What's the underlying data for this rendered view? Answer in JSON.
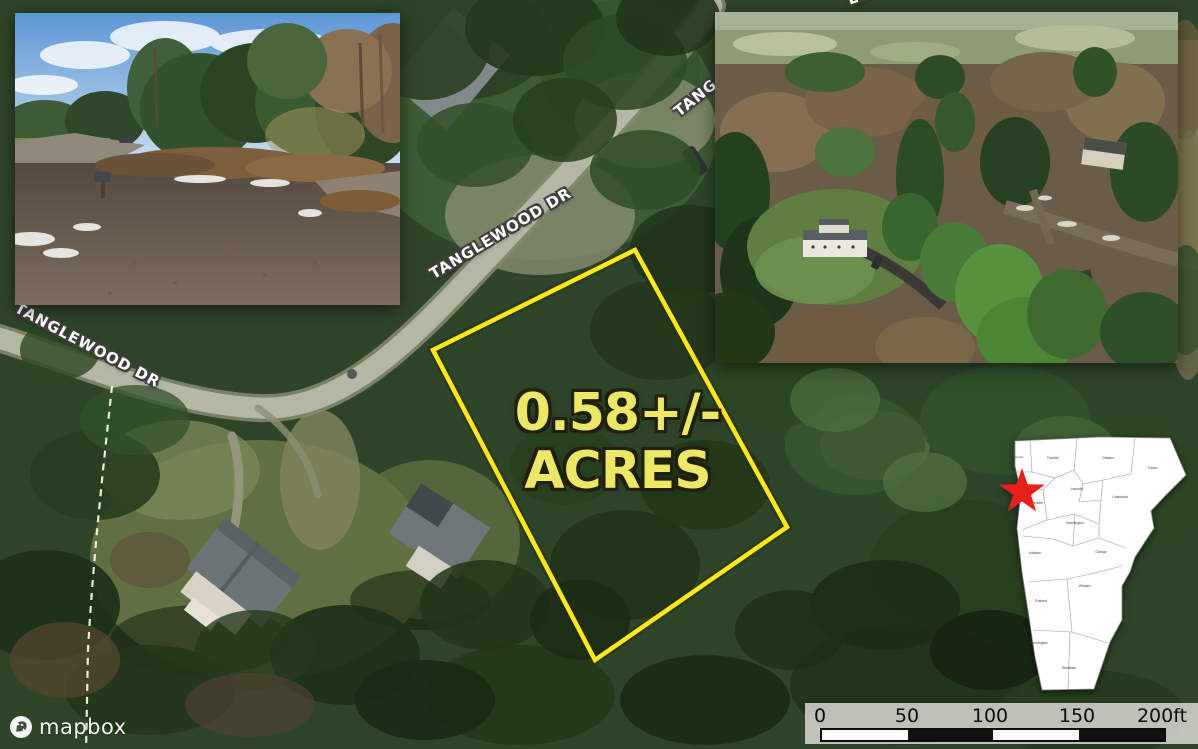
{
  "map": {
    "street_labels": [
      {
        "text": "TANGLEWOOD DR"
      },
      {
        "text": "TANGLEWOOD DR"
      },
      {
        "text": "TANG"
      },
      {
        "text": "EWOO"
      }
    ],
    "parcel": {
      "acreage_line1": "0.58+/-",
      "acreage_line2": "ACRES",
      "outline_color": "#ffe819",
      "label_color": "#ece766"
    }
  },
  "state_map": {
    "counties": [
      "Grand Isle",
      "Franklin",
      "Orleans",
      "Essex",
      "Lamoille",
      "Caledonia",
      "Chittenden",
      "Washington",
      "Addison",
      "Orange",
      "Windsor",
      "Rutland",
      "Bennington",
      "Windham"
    ],
    "marker_color": "#e8201a"
  },
  "scale_bar": {
    "ticks": [
      "0",
      "50",
      "100",
      "150",
      "200ft"
    ],
    "segment_colors": [
      "#ffffff",
      "#111111",
      "#ffffff",
      "#111111"
    ]
  },
  "attribution": {
    "brand": "mapbox"
  }
}
